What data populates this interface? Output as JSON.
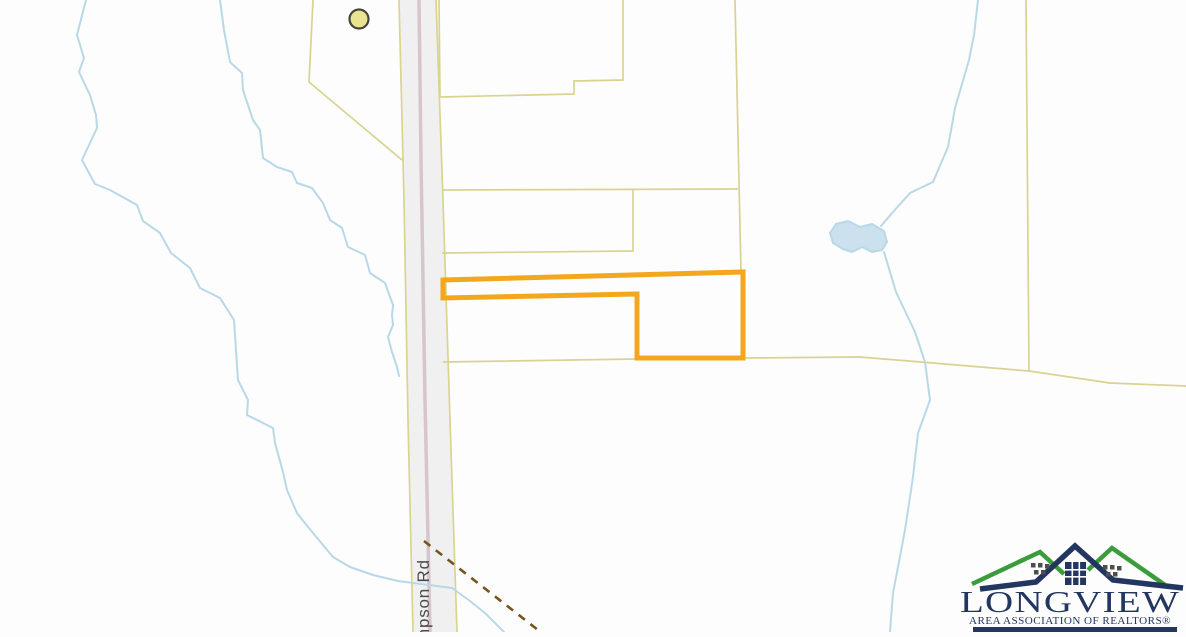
{
  "map": {
    "background": "#fdfdfd",
    "road": {
      "label": "mpson Rd",
      "fill": "#f1f0f1",
      "edge_color": "#d9d48e",
      "centerline_color": "#d6c5cc",
      "outline": [
        [
          399,
          0
        ],
        [
          436,
          0
        ],
        [
          457,
          632
        ],
        [
          413,
          632
        ]
      ],
      "left_edge": [
        [
          399,
          0
        ],
        [
          404,
          200
        ],
        [
          408,
          420
        ],
        [
          413,
          632
        ]
      ],
      "right_edge": [
        [
          436,
          0
        ],
        [
          443,
          200
        ],
        [
          450,
          420
        ],
        [
          457,
          632
        ]
      ],
      "centerline": [
        [
          419,
          0
        ],
        [
          421,
          160
        ],
        [
          425,
          400
        ],
        [
          430,
          632
        ]
      ]
    },
    "parcel_lines": {
      "color": "#d8d392",
      "width": 1.7,
      "lines": [
        [
          [
            313,
            0
          ],
          [
            309,
            82
          ],
          [
            402,
            160
          ]
        ],
        [
          [
            439,
            0
          ],
          [
            440,
            97
          ],
          [
            574,
            94
          ],
          [
            574,
            81
          ],
          [
            623,
            80
          ],
          [
            623,
            0
          ]
        ],
        [
          [
            735,
            0
          ],
          [
            741,
            272
          ]
        ],
        [
          [
            442,
            190
          ],
          [
            738,
            189
          ]
        ],
        [
          [
            633,
            190
          ],
          [
            633,
            252
          ]
        ],
        [
          [
            442,
            253
          ],
          [
            633,
            251
          ]
        ],
        [
          [
            443,
            362
          ],
          [
            637,
            359
          ],
          [
            745,
            358
          ],
          [
            860,
            357
          ],
          [
            1029,
            371
          ],
          [
            1110,
            383
          ],
          [
            1186,
            386
          ]
        ],
        [
          [
            1026,
            0
          ],
          [
            1029,
            371
          ]
        ]
      ]
    },
    "creeks": {
      "color": "#b9d8e7",
      "width": 2,
      "lines": [
        [
          [
            86,
            0
          ],
          [
            77,
            35
          ],
          [
            84,
            58
          ],
          [
            79,
            72
          ],
          [
            90,
            95
          ],
          [
            96,
            115
          ],
          [
            97,
            128
          ],
          [
            82,
            160
          ],
          [
            95,
            184
          ],
          [
            110,
            190
          ],
          [
            137,
            205
          ],
          [
            143,
            221
          ],
          [
            160,
            233
          ],
          [
            171,
            253
          ],
          [
            190,
            268
          ],
          [
            200,
            288
          ],
          [
            220,
            298
          ],
          [
            234,
            320
          ],
          [
            238,
            380
          ],
          [
            248,
            400
          ],
          [
            247,
            415
          ],
          [
            273,
            428
          ],
          [
            275,
            443
          ],
          [
            283,
            472
          ],
          [
            287,
            490
          ],
          [
            297,
            513
          ],
          [
            308,
            527
          ],
          [
            333,
            557
          ],
          [
            350,
            567
          ],
          [
            373,
            575
          ],
          [
            398,
            581
          ],
          [
            452,
            588
          ],
          [
            470,
            601
          ],
          [
            486,
            614
          ],
          [
            504,
            632
          ]
        ],
        [
          [
            220,
            0
          ],
          [
            224,
            30
          ],
          [
            230,
            62
          ],
          [
            242,
            73
          ],
          [
            243,
            90
          ],
          [
            253,
            120
          ],
          [
            260,
            130
          ],
          [
            263,
            158
          ],
          [
            277,
            167
          ],
          [
            292,
            172
          ],
          [
            297,
            183
          ],
          [
            312,
            188
          ],
          [
            323,
            203
          ],
          [
            330,
            220
          ],
          [
            342,
            228
          ],
          [
            348,
            247
          ],
          [
            365,
            255
          ],
          [
            370,
            273
          ],
          [
            385,
            283
          ],
          [
            393,
            305
          ],
          [
            392,
            315
          ],
          [
            393,
            325
          ],
          [
            388,
            337
          ],
          [
            392,
            352
          ],
          [
            397,
            367
          ],
          [
            399,
            376
          ]
        ],
        [
          [
            978,
            0
          ],
          [
            974,
            35
          ],
          [
            969,
            60
          ],
          [
            955,
            108
          ],
          [
            948,
            147
          ],
          [
            933,
            182
          ],
          [
            910,
            193
          ],
          [
            893,
            212
          ],
          [
            881,
            226
          ]
        ],
        [
          [
            884,
            252
          ],
          [
            896,
            292
          ],
          [
            915,
            332
          ],
          [
            925,
            362
          ],
          [
            930,
            400
          ],
          [
            918,
            433
          ],
          [
            913,
            477
          ],
          [
            905,
            530
          ],
          [
            898,
            567
          ],
          [
            893,
            593
          ],
          [
            890,
            632
          ]
        ]
      ]
    },
    "pond": {
      "fill": "#cbe1ee",
      "stroke": "#b9d8e7",
      "points": [
        [
          836,
          224
        ],
        [
          830,
          233
        ],
        [
          833,
          243
        ],
        [
          843,
          249
        ],
        [
          852,
          252
        ],
        [
          862,
          247
        ],
        [
          872,
          252
        ],
        [
          882,
          250
        ],
        [
          887,
          242
        ],
        [
          884,
          231
        ],
        [
          872,
          224
        ],
        [
          860,
          227
        ],
        [
          848,
          221
        ]
      ]
    },
    "dashed_trail": {
      "color": "#73551d",
      "width": 2.6,
      "dash": "8 7",
      "points": [
        [
          424,
          541
        ],
        [
          547,
          637
        ]
      ]
    },
    "highlight_parcel": {
      "color": "#f3a71d",
      "width": 5,
      "points": [
        [
          443,
          280
        ],
        [
          743,
          272
        ],
        [
          743,
          358
        ],
        [
          637,
          358
        ],
        [
          637,
          294
        ],
        [
          443,
          298
        ]
      ]
    },
    "marker": {
      "cx": 359,
      "cy": 19,
      "r": 9.5,
      "fill": "#eae390",
      "stroke": "#45453a",
      "stroke_width": 2.2
    }
  },
  "logo": {
    "title": "LONGVIEW",
    "subtitle": "AREA ASSOCIATION OF REALTORS®",
    "navy": "#22365f",
    "green": "#3b9c3b",
    "window_gray": "#4e4e4e"
  }
}
